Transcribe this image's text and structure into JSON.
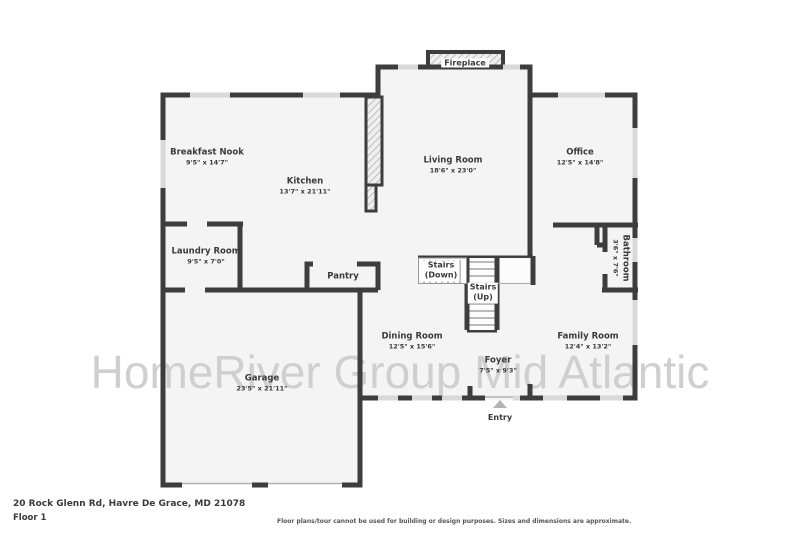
{
  "watermark": "HomeRiver Group Mid Atlantic",
  "fireplace": {
    "label": "Fireplace"
  },
  "entry": {
    "label": "Entry"
  },
  "stairs": {
    "down_line1": "Stairs",
    "down_line2": "(Down)",
    "up_line1": "Stairs",
    "up_line2": "(Up)"
  },
  "rooms": [
    {
      "name": "Breakfast Nook",
      "dims": "9'5\" x 14'7\""
    },
    {
      "name": "Kitchen",
      "dims": "13'7\" x 21'11\""
    },
    {
      "name": "Living Room",
      "dims": "18'6\" x 23'0\""
    },
    {
      "name": "Office",
      "dims": "12'5\" x 14'8\""
    },
    {
      "name": "Laundry Room",
      "dims": "9'5\" x 7'0\""
    },
    {
      "name": "Pantry",
      "dims": ""
    },
    {
      "name": "Dining Room",
      "dims": "12'5\" x 15'6\""
    },
    {
      "name": "Family Room",
      "dims": "12'4\" x 13'2\""
    },
    {
      "name": "Foyer",
      "dims": "7'5\" x 9'3\""
    },
    {
      "name": "Garage",
      "dims": "23'5\" x 21'11\""
    },
    {
      "name": "Bathroom",
      "dims": "3'6\" x 7'6\""
    }
  ],
  "footer": {
    "address": "20 Rock Glenn Rd, Havre De Grace, MD 21078",
    "floor_label": "Floor 1",
    "disclaimer": "Floor plans/tour cannot be used for building or design purposes. Sizes and dimensions are approximate."
  },
  "colors": {
    "wall": "#3d3d3d",
    "room_fill": "#f4f4f4",
    "window": "#d9d9d9",
    "watermark": "#cfcfcf",
    "text": "#3a3a3a"
  }
}
